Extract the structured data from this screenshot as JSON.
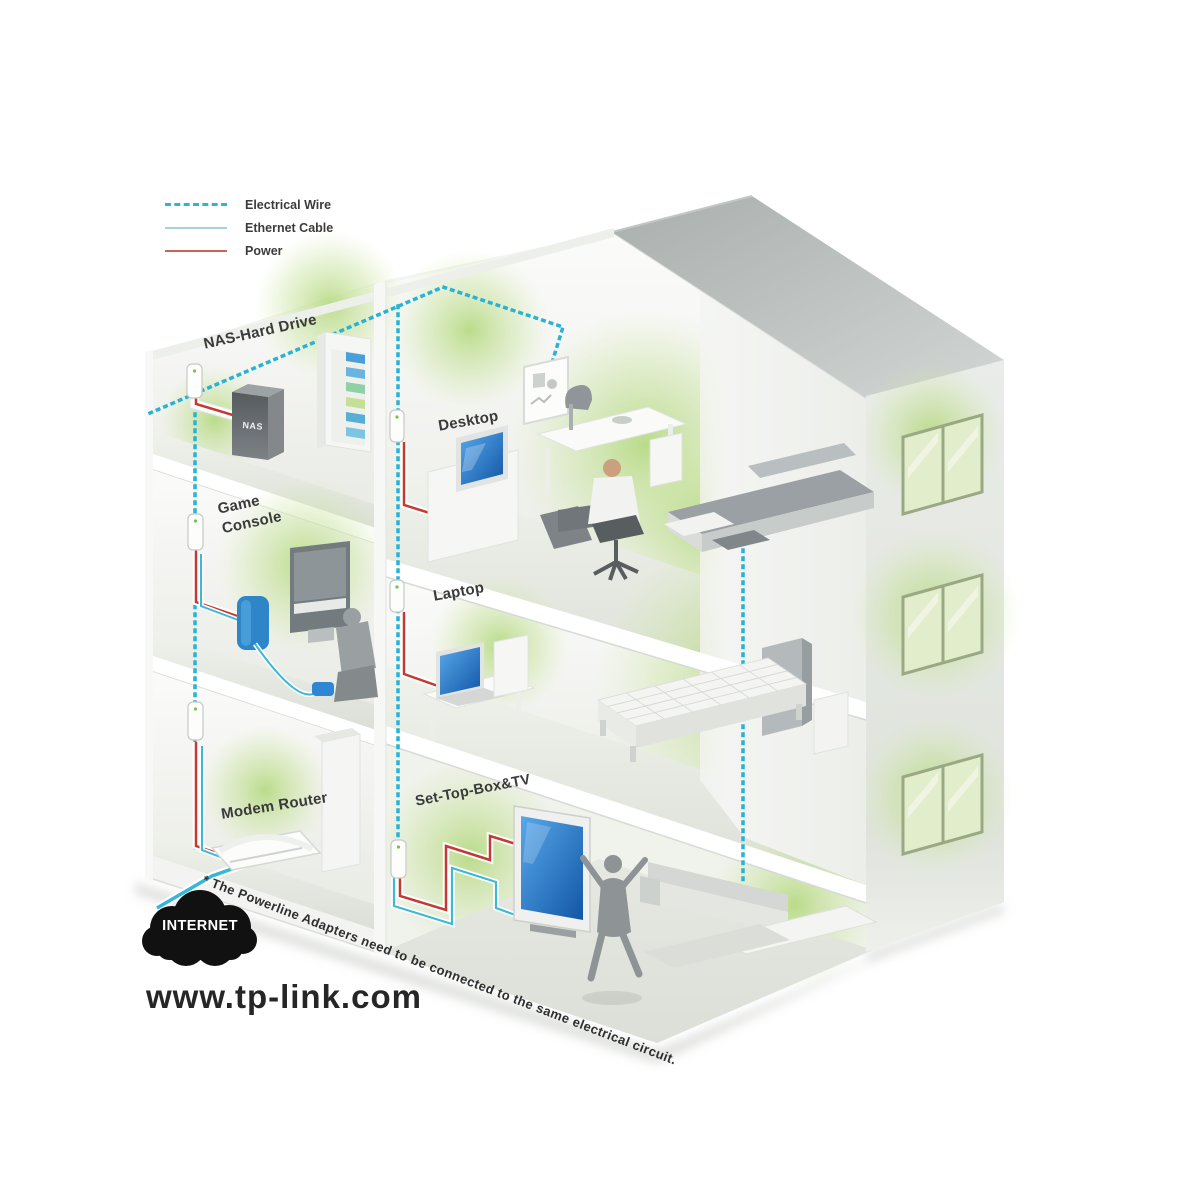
{
  "legend": {
    "items": [
      {
        "label": "Electrical Wire",
        "style": "dashed",
        "color": "#2fb4d8"
      },
      {
        "label": "Ethernet Cable",
        "style": "solid",
        "color": "#a4d2de"
      },
      {
        "label": "Power",
        "style": "solid",
        "color": "#c4645c"
      }
    ]
  },
  "labels": {
    "nas": "NAS-Hard Drive",
    "desktop": "Desktop",
    "game": "Game Console",
    "laptop": "Laptop",
    "modem": "Modem Router",
    "stb": "Set-Top-Box&TV"
  },
  "devices": {
    "nas_badge": "NAS"
  },
  "internet_label": "INTERNET",
  "website": "www.tp-link.com",
  "footnote": "* The Powerline Adapters need to be connected to the same electrical circuit.",
  "colors": {
    "electrical_wire": "#2fb4d8",
    "ethernet_cable": "#3fb8d8",
    "power": "#c43a32",
    "glow_green": "#b5d97e",
    "screen_blue": "#2f86d4",
    "cloud": "#111111"
  }
}
